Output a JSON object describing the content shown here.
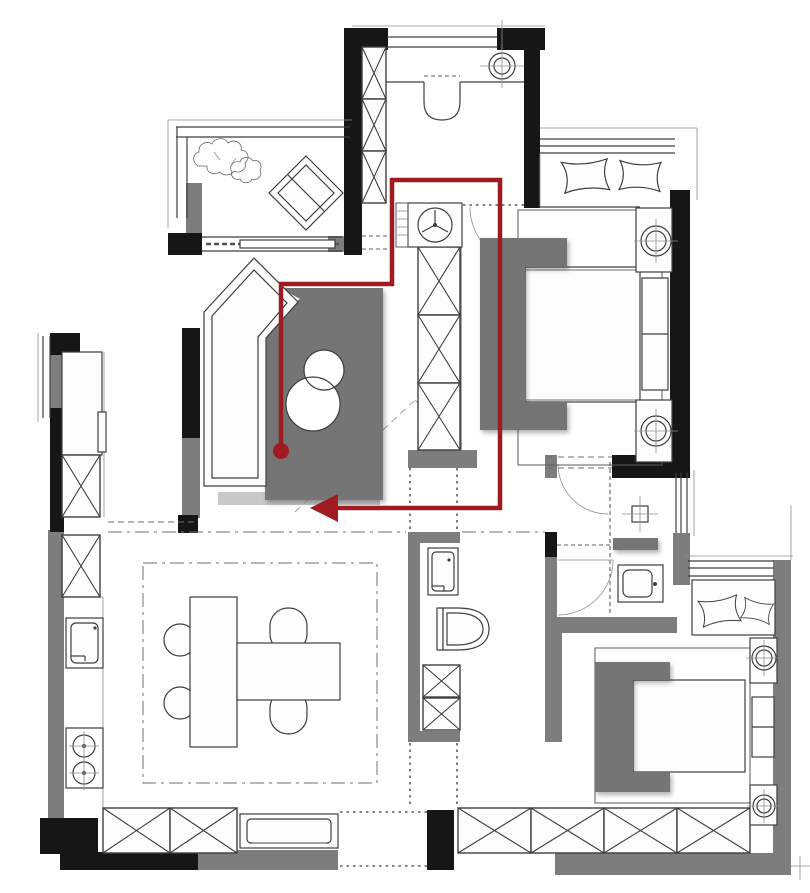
{
  "meta": {
    "type": "floor-plan",
    "description": "Residential apartment floor plan sketch with a dark-red walking route annotation"
  },
  "colors": {
    "background": "#ffffff",
    "wall_black": "#161616",
    "wall_gray": "#7d7d7d",
    "furniture_gray": "#747474",
    "furniture_shadow": "#b0b0b0",
    "line_dark": "#3e3e3e",
    "line_light": "#8f8f8f",
    "route_red": "#9e1c21"
  },
  "route": {
    "points": "281,451 281,284 392,284 392,180 500,180 500,508 336,508",
    "arrowhead": "310,508 338,494 338,522",
    "start_dot": {
      "cx": "281",
      "cy": "451",
      "r": "8"
    },
    "color": "#9e1c21",
    "width": "4.5"
  },
  "symbols": [
    "entry-door",
    "ceiling-light",
    "shoe-cabinet",
    "washing-machine",
    "tall-cabinet",
    "wardrobe",
    "bed",
    "headboard",
    "pillow",
    "bedside-lamp",
    "bench",
    "toilet",
    "washbasin",
    "shower-drain",
    "storage-cabinet",
    "kitchen-sink",
    "cooktop",
    "dining-table",
    "dining-chair",
    "tv-cabinet",
    "plant",
    "lounge-chair",
    "sliding-window",
    "bay-window",
    "walking-route"
  ]
}
